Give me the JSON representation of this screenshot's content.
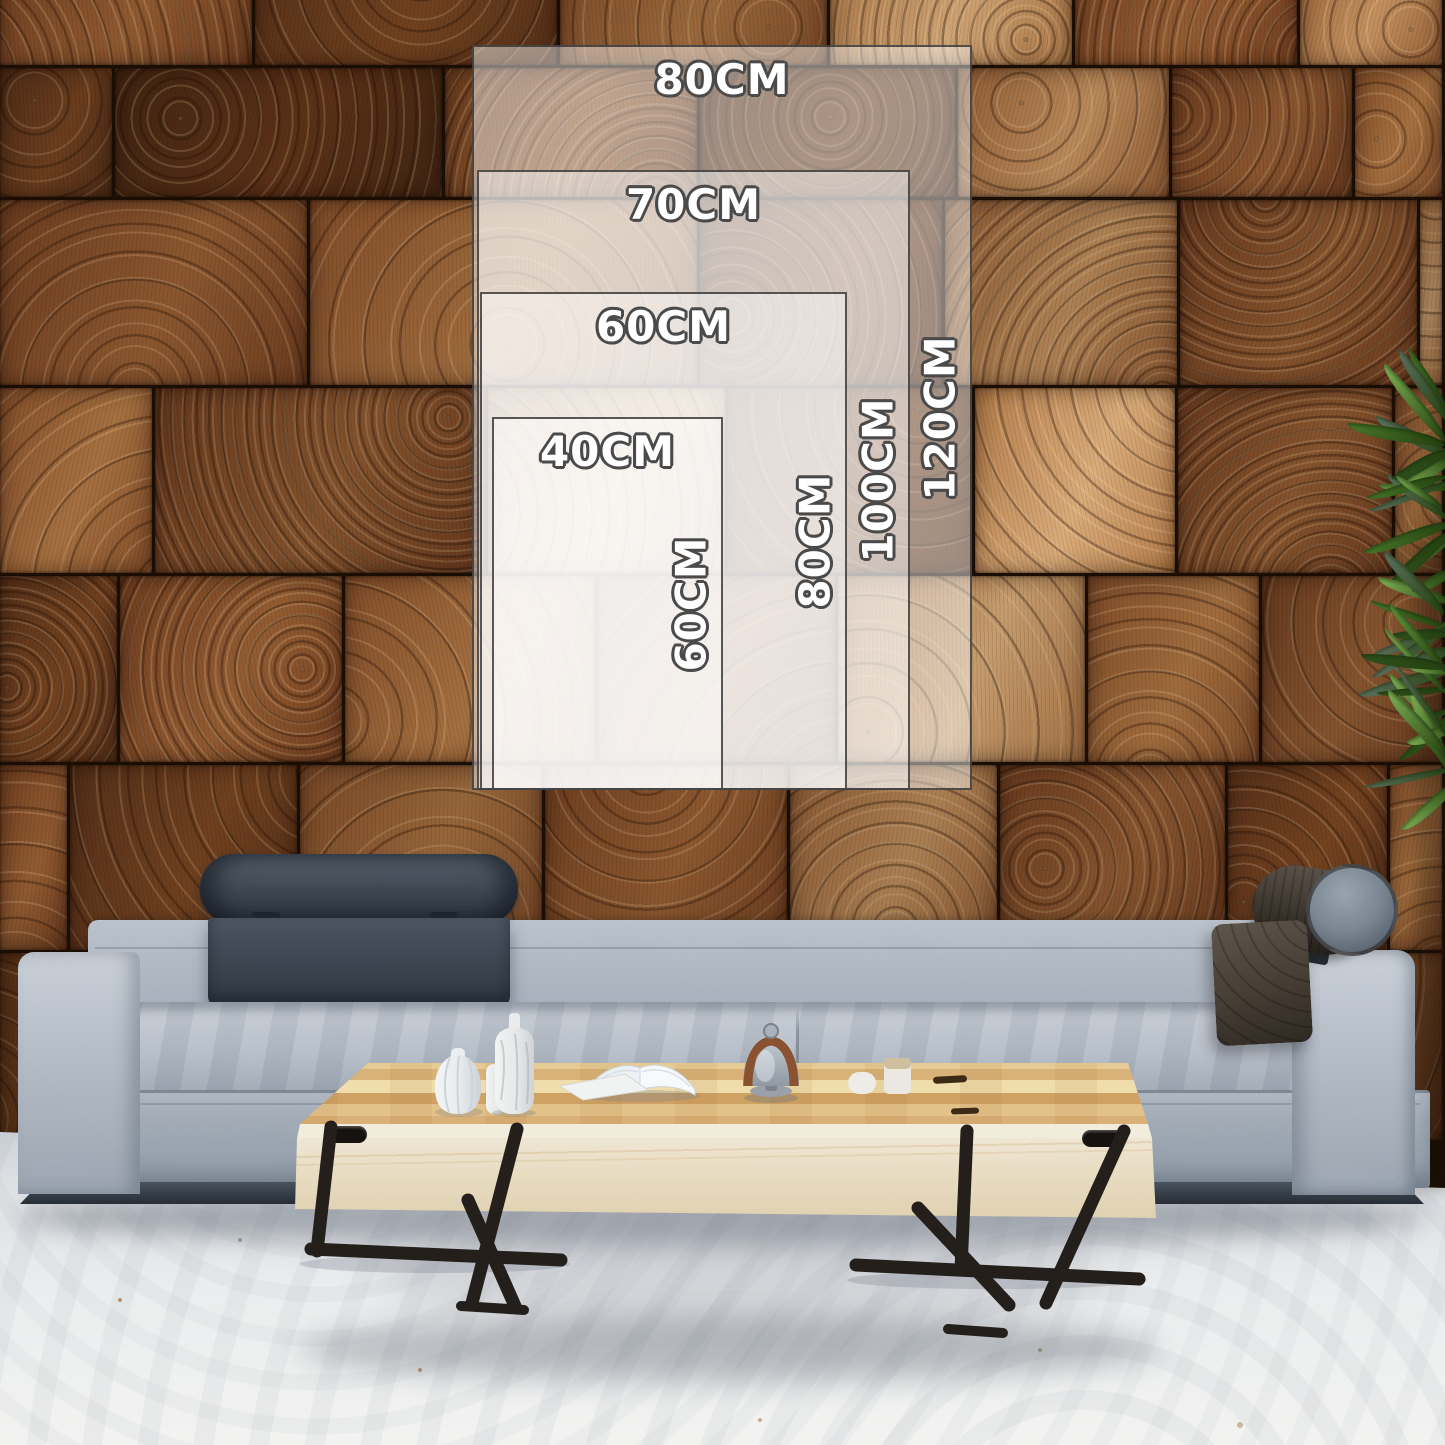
{
  "size_guide": {
    "unit": "CM",
    "sizes": [
      {
        "width_label": "80CM",
        "height_label": "120CM"
      },
      {
        "width_label": "70CM",
        "height_label": "100CM"
      },
      {
        "width_label": "60CM",
        "height_label": "80CM"
      },
      {
        "width_label": "40CM",
        "height_label": "60CM"
      }
    ],
    "overlay_fill": "rgba(255,255,255,0.46)",
    "overlay_border": "#303030",
    "label_color": "#ffffff",
    "label_outline": "#4a4a4a"
  },
  "scene": {
    "description": "living room with end-grain wood block wall, gray fabric sofa, maple coffee table, plant at right edge",
    "palette": {
      "wood_tones": [
        [
          "#3f2412",
          "#5a3117"
        ],
        [
          "#532f18",
          "#6f401f"
        ],
        [
          "#6b3c1f",
          "#8a5730"
        ],
        [
          "#7b4a28",
          "#9c6a3d"
        ],
        [
          "#8f5c35",
          "#b8895a"
        ],
        [
          "#a87545",
          "#cda273"
        ]
      ],
      "wood_seam": "#1a0d04",
      "sofa_light": "#c9cfd7",
      "sofa_mid": "#aab3be",
      "sofa_dark": "#8a95a2",
      "sofa_rail": "#39424c",
      "headrest_navy": "#3d4550",
      "bolster_brown": "#3f3831",
      "bolster_cap": "#7b8693",
      "pillow_espresso": "#463d34",
      "table_maple": "#e0ba7e",
      "table_cream": "#f0e9d8",
      "table_metal": "#241f1b",
      "floor_light": "#f2f2f1",
      "floor_dark": "#ccd1d6",
      "plant_greens": [
        "#2e511c",
        "#47762a",
        "#63973c",
        "#7fb254",
        "#5d7260"
      ]
    }
  }
}
